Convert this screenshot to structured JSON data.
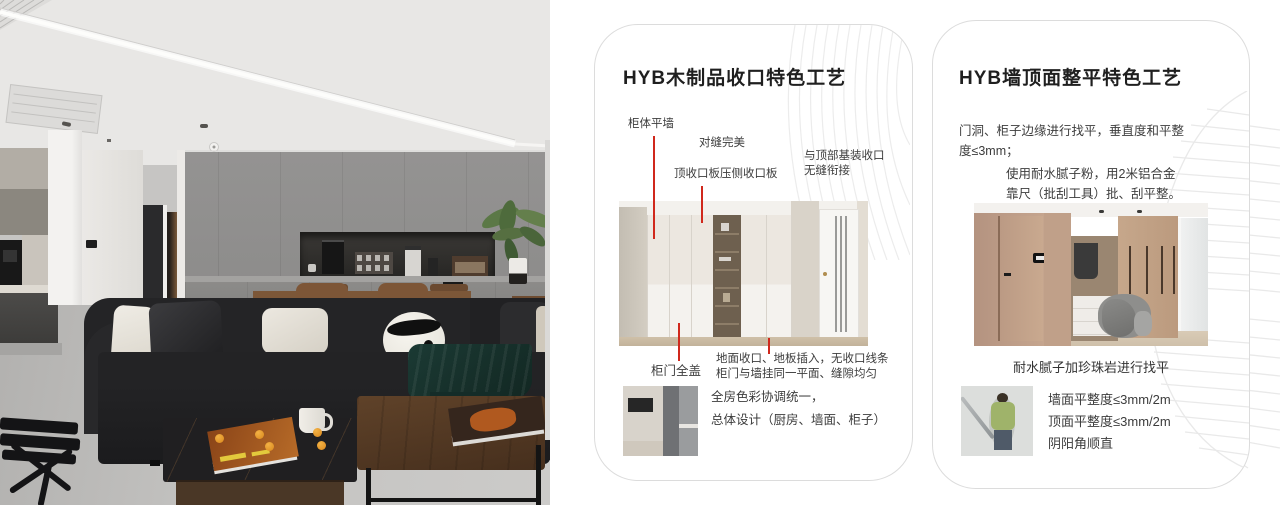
{
  "page": {
    "background": "#ffffff"
  },
  "colors": {
    "annotation_red": "#d0281c",
    "card_border": "#dcdcdc",
    "title_text": "#1f1f1f",
    "body_text": "#3c3c3c",
    "deco_line": "#e9e9e9"
  },
  "cards": [
    {
      "title": "HYB木制品收口特色工艺",
      "labels": {
        "wall": "柜体平墙",
        "seam": "对缝完美",
        "top_panel": "顶收口板压侧收口板",
        "ceiling_l1": "与顶部基装收口",
        "ceiling_l2": "无缝衔接",
        "door_cover": "柜门全盖",
        "floor_l1": "地面收口、地板插入，无收口线条",
        "floor_l2": "柜门与墙挂同一平面、缝隙均匀",
        "note_l1": "全房色彩协调统一，",
        "note_l2": "总体设计（厨房、墙面、柜子）"
      }
    },
    {
      "title": "HYB墙顶面整平特色工艺",
      "para1_l1": "门洞、柜子边缘进行找平，垂直度和平整",
      "para1_l2": "度≤3mm；",
      "para2_l1": "使用耐水腻子粉，用2米铝合金",
      "para2_l2": "靠尺（批刮工具）批、刮平整。",
      "caption": "耐水腻子加珍珠岩进行找平",
      "specs": [
        "墙面平整度≤3mm/2m",
        "顶面平整度≤3mm/2m",
        "阴阳角顺直"
      ]
    }
  ]
}
